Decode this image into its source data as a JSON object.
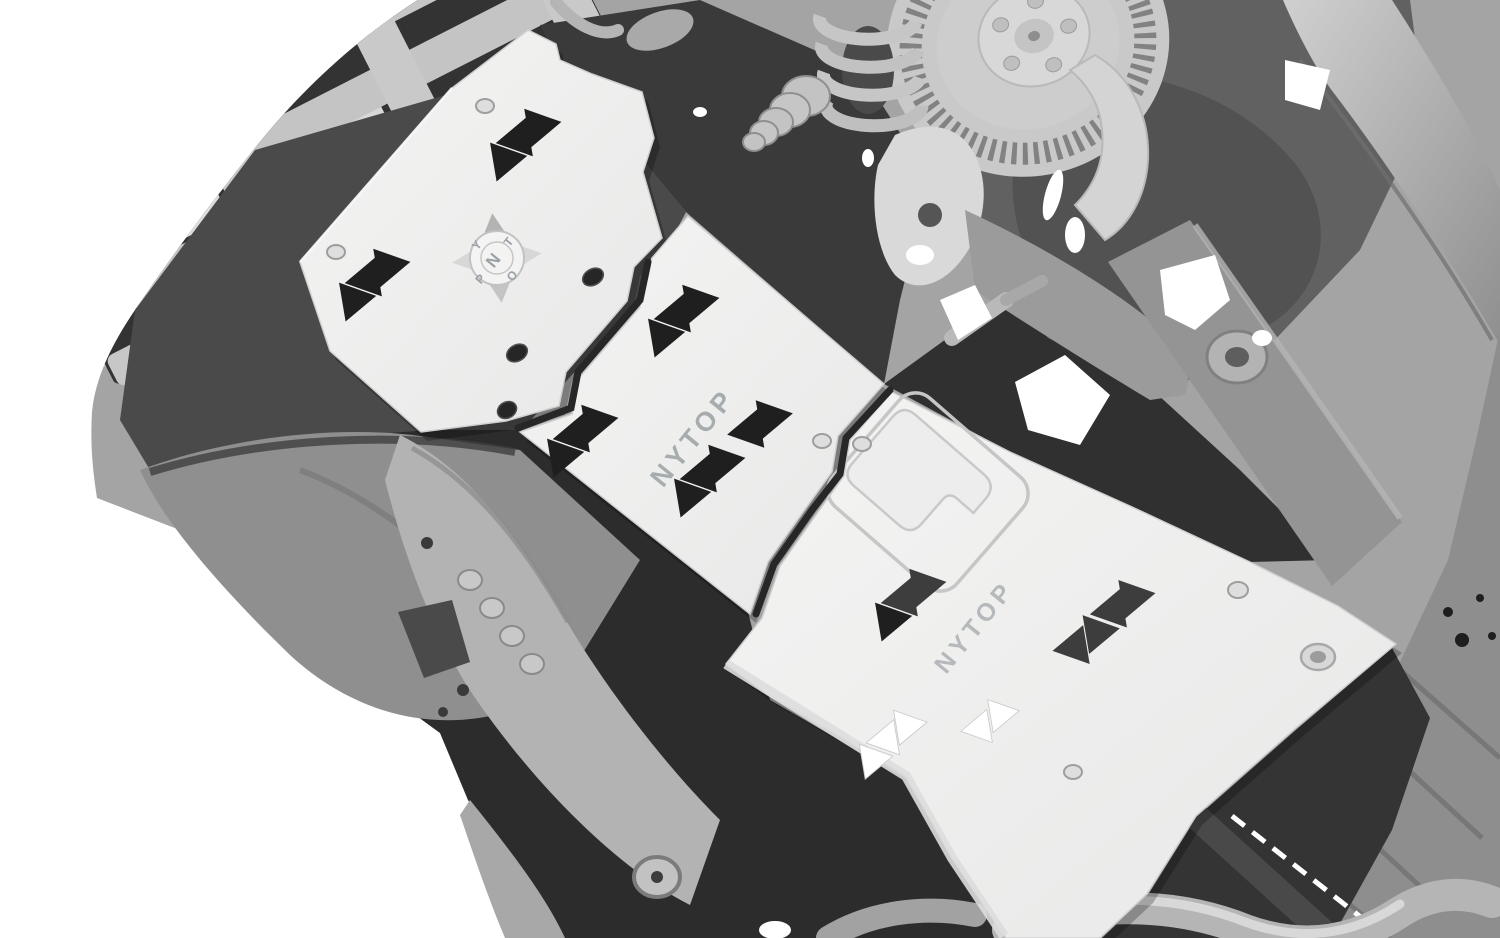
{
  "plates": {
    "front": {
      "compass": {
        "center": "N",
        "nw": "Y",
        "ne": "T",
        "sw": "P",
        "se": "O"
      }
    },
    "middle": {
      "brand_text": "NYTOP"
    },
    "rear": {
      "brand_text": "NYTOP"
    }
  },
  "icons": {
    "compass_logo": "compass-rose",
    "vent_cutout": "triangle-cutout"
  },
  "palette": {
    "background": "#ffffff",
    "plate_white": "#efefee",
    "plate_edge": "#cfcfcf",
    "scan_light_gray": "#c6c6c6",
    "scan_mid_gray": "#8f8f8f",
    "scan_dark_gray": "#3a3a3a",
    "cutout_black": "#1f1f1f",
    "etched_text_gray": "#a7acaf"
  }
}
